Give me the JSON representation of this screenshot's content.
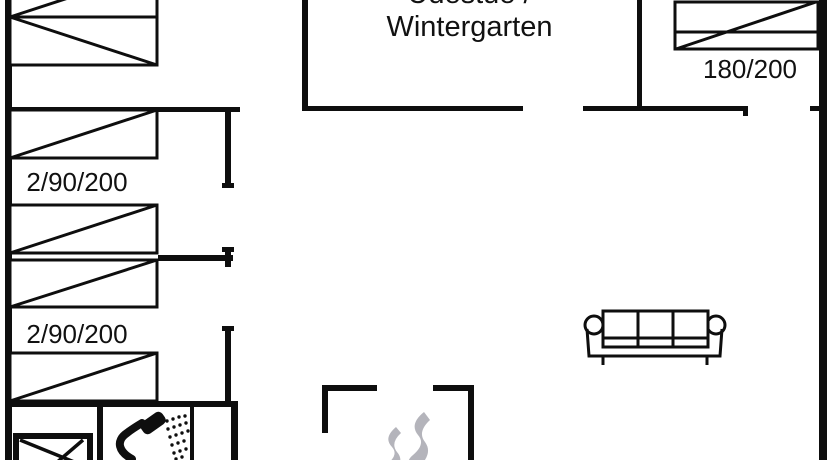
{
  "document": {
    "type": "holiday-house floor plan drawing",
    "colors": {
      "background": "#ffffff",
      "lines": "#0e0e0e",
      "smoke": "#b4b4bb",
      "text": "#111111"
    },
    "labels": {
      "conservatory_line1": "Udestue /",
      "conservatory_line2": "Wintergarten",
      "double_bed_size": "180/200",
      "bunk_room_1_size": "2/90/200",
      "bunk_room_2_size": "2/90/200"
    },
    "icons": {
      "single_bed": "single-bed-icon",
      "double_bed": "double-bed-icon",
      "sofa": "sofa-icon",
      "stove": "wood-stove-smoke-icon",
      "shower": "shower-head-icon",
      "washbasin": "washbasin-icon"
    }
  }
}
